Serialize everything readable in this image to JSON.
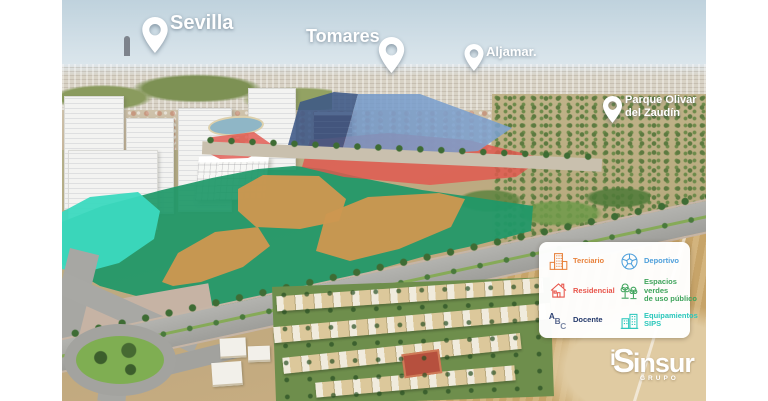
{
  "pins": {
    "sevilla": {
      "label": "Sevilla"
    },
    "tomares": {
      "label": "Tomares"
    },
    "aljamar": {
      "label": "Aljamar."
    },
    "parque_olivar": {
      "line1": "Parque Olivar",
      "line2": "del Zaudín"
    }
  },
  "legend": {
    "items": [
      {
        "id": "terciario",
        "label": "Terciario",
        "color": "#E8823C",
        "icon": "office-building-icon"
      },
      {
        "id": "residencial",
        "label": "Residencial",
        "color": "#E8554B",
        "icon": "house-icon"
      },
      {
        "id": "docente",
        "label": "Docente",
        "color": "#24396B",
        "icon": "abc-letters-icon"
      },
      {
        "id": "deportivo",
        "label": "Deportivo",
        "color": "#4D9FDB",
        "icon": "soccer-ball-icon"
      },
      {
        "id": "espacios_verdes",
        "line1": "Espacios verdes",
        "line2": "de uso público",
        "color": "#3FA45C",
        "icon": "trees-icon"
      },
      {
        "id": "equipamientos",
        "line1": "Equipamientos",
        "line2": "SIPS",
        "color": "#2AC7BB",
        "icon": "public-buildings-icon"
      }
    ]
  },
  "zones": [
    {
      "name": "espacios-verdes-zone",
      "category": "Espacios verdes de uso público",
      "color": "#1F9868"
    },
    {
      "name": "equipamientos-sips-zone",
      "category": "Equipamientos SIPS",
      "color": "#3BD9BF"
    },
    {
      "name": "terciario-zone-a",
      "category": "Terciario",
      "color": "#CD9750"
    },
    {
      "name": "terciario-zone-b",
      "category": "Terciario",
      "color": "#CD9750"
    },
    {
      "name": "terciario-zone-c",
      "category": "Terciario",
      "color": "#CD9750"
    },
    {
      "name": "residencial-zone-west",
      "category": "Residencial",
      "color": "#E2574E"
    },
    {
      "name": "residencial-zone-east",
      "category": "Residencial",
      "color": "#E2574E"
    },
    {
      "name": "docente-zone",
      "category": "Docente",
      "color": "#3C5886"
    },
    {
      "name": "deportivo-zone",
      "category": "Deportivo",
      "color": "#7FA9DC"
    }
  ],
  "logo": {
    "monogram_i": "i",
    "monogram_s": "S",
    "name": "insur",
    "subtitle": "GRUPO"
  }
}
